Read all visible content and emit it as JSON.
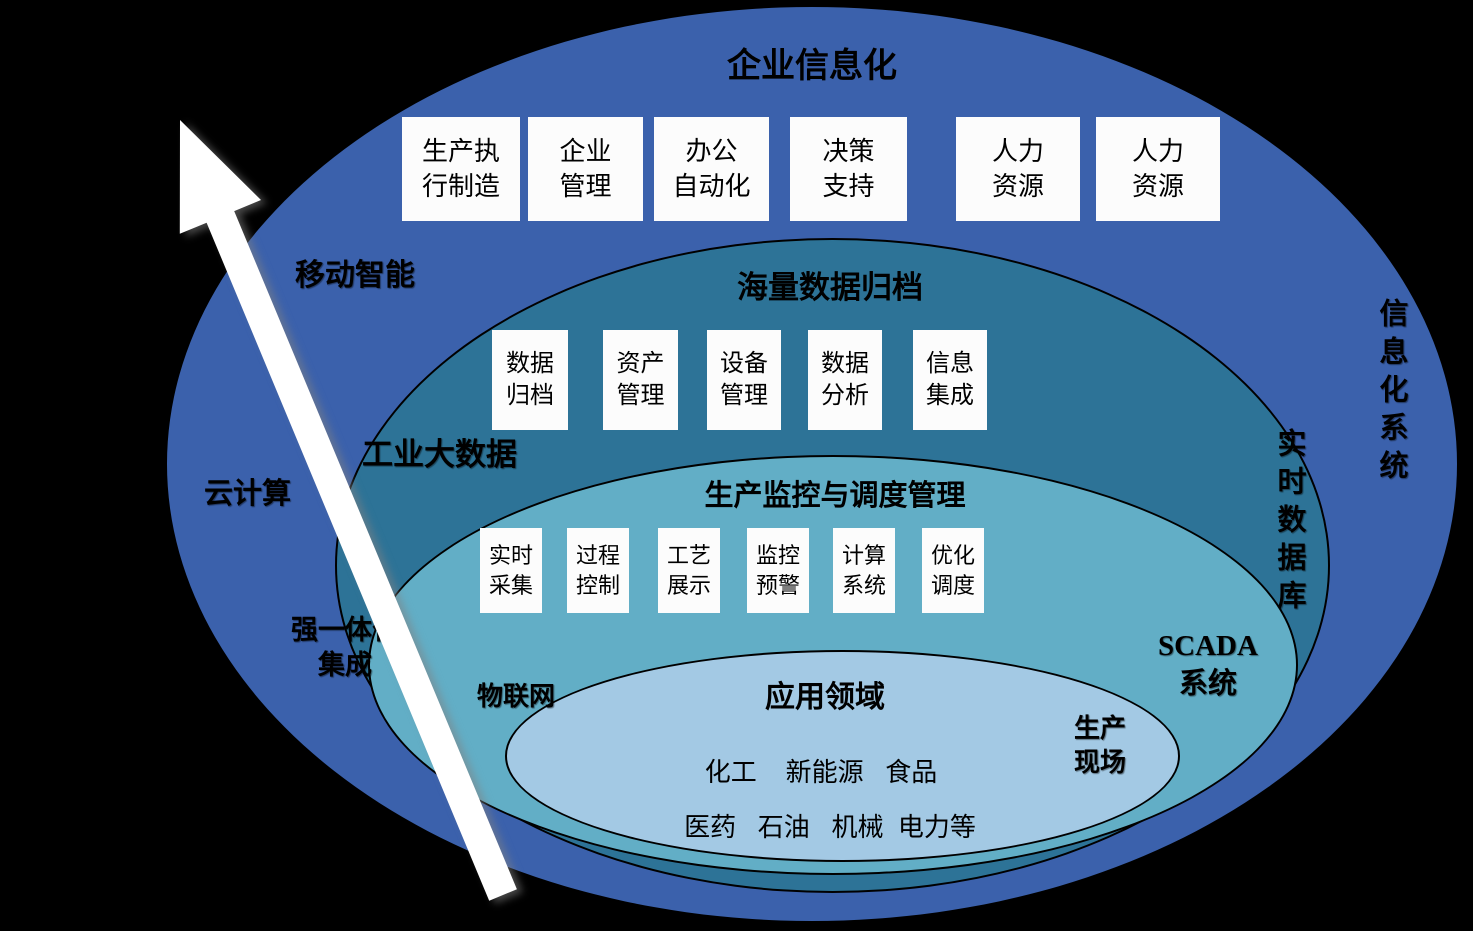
{
  "colors": {
    "background": "#000000",
    "outer_ring": "#3b61ac",
    "archive_ring": "#2d7397",
    "monitor_ring": "#62aec6",
    "application_ring": "#a3c9e4",
    "box_background": "#fcfcfc",
    "ring_border": "#000000",
    "arrow": "#ffffff"
  },
  "rings": {
    "outer": {
      "title": "企业信息化",
      "boxes": [
        "生产执\n行制造",
        "企业\n管理",
        "办公\n自动化",
        "决策\n支持",
        "人力\n资源",
        "人力\n资源"
      ]
    },
    "archive": {
      "title": "海量数据归档",
      "boxes": [
        "数据\n归档",
        "资产\n管理",
        "设备\n管理",
        "数据\n分析",
        "信息\n集成"
      ]
    },
    "monitor": {
      "title": "生产监控与调度管理",
      "boxes": [
        "实时\n采集",
        "过程\n控制",
        "工艺\n展示",
        "监控\n预警",
        "计算\n系统",
        "优化\n调度"
      ]
    },
    "application": {
      "title": "应用领域",
      "industries_row1": "化工    新能源   食品",
      "industries_row2": "医药   石油   机械  电力等"
    }
  },
  "side_labels": {
    "mobile": "移动智能",
    "bigdata": "工业大数据",
    "cloud": "云计算",
    "integration": "强一体化\n集成",
    "iot": "物联网",
    "scada": "SCADA\n系统",
    "production_site": "生产\n现场",
    "realtime_db": "实时数据库",
    "info_system": "信息化系统"
  },
  "arrow": {
    "meaning": "upward-arrow"
  }
}
